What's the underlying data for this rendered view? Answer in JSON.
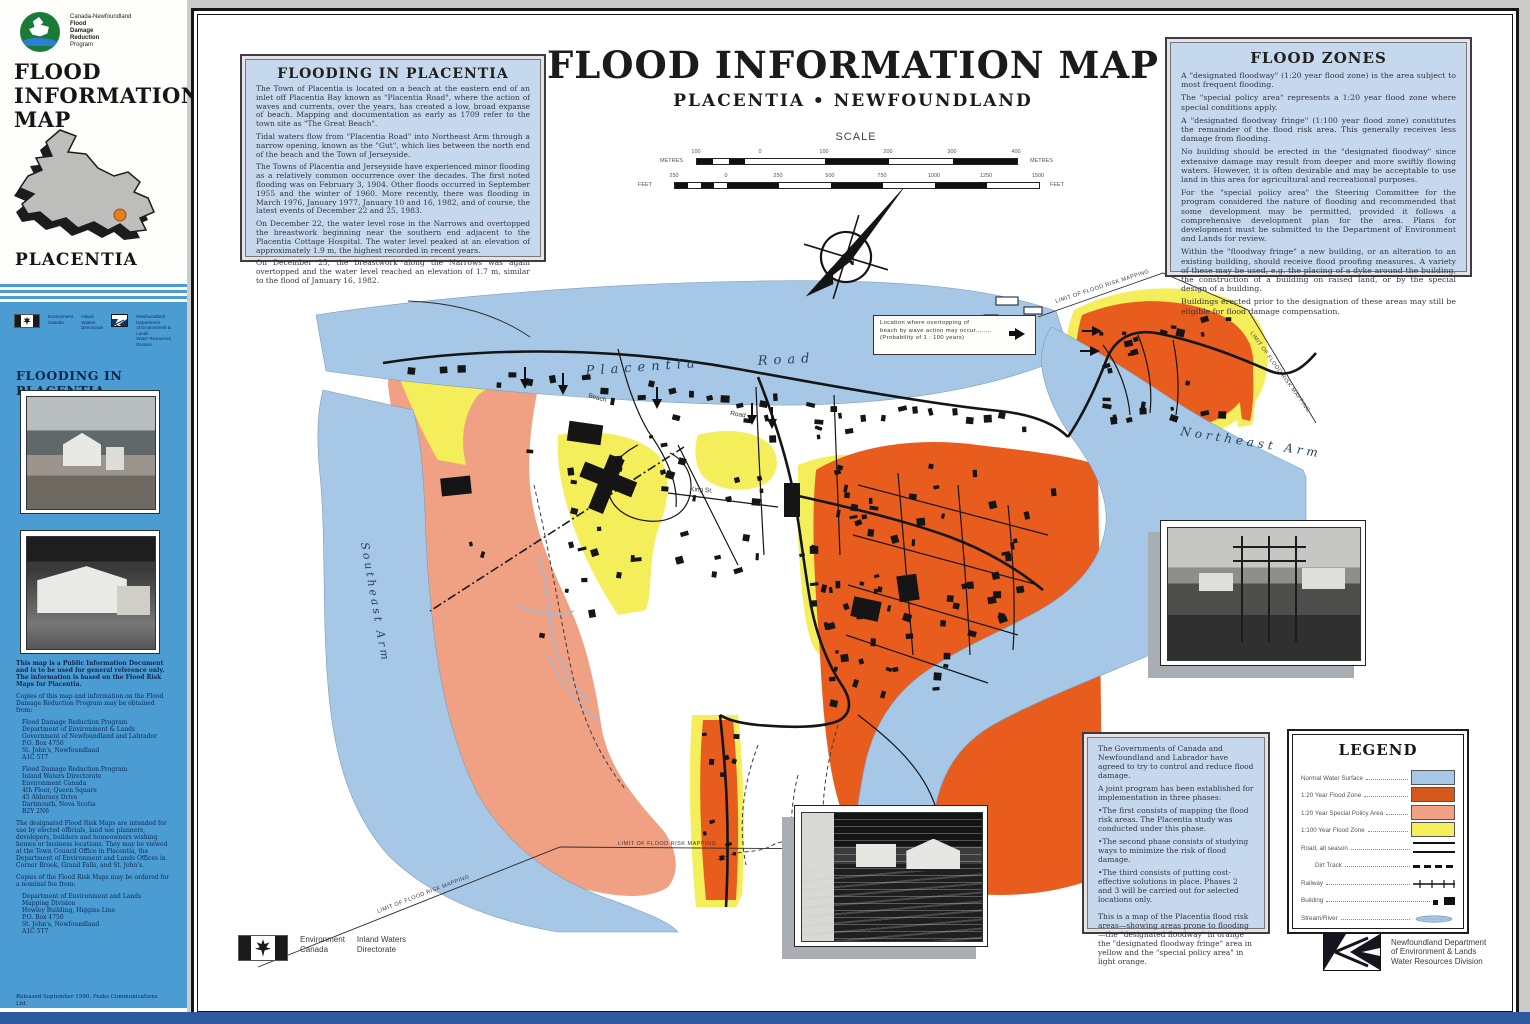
{
  "page": {
    "bottom_strip_color": "#2d5a9e"
  },
  "sidebar": {
    "program_logo": {
      "line1": "Canada-Newfoundland",
      "line2": "Flood",
      "line3": "Damage",
      "line4": "Reduction",
      "line5": "Program"
    },
    "title_line1": "FLOOD",
    "title_line2": "INFORMATION",
    "title_line3": "MAP",
    "region": "PLACENTIA",
    "logos": {
      "env1": "Environment",
      "env2": "Canada",
      "iw1": "Inland Waters",
      "iw2": "Directorate",
      "nf1": "Newfoundland Department",
      "nf2": "of Environment & Lands",
      "nf3": "Water Resources Division"
    },
    "heading": "FLOODING IN PLACENTIA",
    "paragraph1": "This map is a Public Information Document and is to be used for general reference only. The information is based on the Flood Risk Maps for Placentia.",
    "paragraph2": "Copies of this map and information on the Flood Damage Reduction Program may be obtained from:",
    "address1": "Flood Damage Reduction Program\nDepartment of Environment & Lands\nGovernment of Newfoundland and Labrador\nP.O. Box 4750\nSt. John's, Newfoundland\nA1C 5T7",
    "address2": "Flood Damage Reduction Program\nInland Waters Directorate\nEnvironment Canada\n4th Floor, Queen Square\n45 Alderney Drive\nDartmouth, Nova Scotia\nB2Y 2N6",
    "paragraph3": "The designated Flood Risk Maps are intended for use by elected officials, land use planners, developers, builders and homeowners wishing homes or business locations. They may be viewed at the Town Council Office in Placentia, the Department of Environment and Lands Offices in Corner Brook, Grand Falls, and St. John's.",
    "paragraph4": "Copies of the Flood Risk Maps may be ordered for a nominal fee from:",
    "address3": "Department of Environment and Lands\nMapping Division\nHowley Building, Higgins Line\nP.O. Box 4750\nSt. John's, Newfoundland\nA1C 5T7",
    "footnote": "Released September 1990, Peaks Communications Ltd."
  },
  "header": {
    "title": "FLOOD INFORMATION MAP",
    "subtitle": "PLACENTIA • NEWFOUNDLAND"
  },
  "scale": {
    "label": "SCALE",
    "metres_unit": "METRES",
    "feet_unit": "FEET",
    "metres_ticks": [
      "100",
      "0",
      "100",
      "200",
      "300",
      "400"
    ],
    "feet_ticks": [
      "250",
      "0",
      "250",
      "500",
      "750",
      "1000",
      "1250",
      "1500"
    ]
  },
  "flooding_box": {
    "title": "FLOODING IN PLACENTIA",
    "paragraphs": [
      "The Town of Placentia is located on a beach at the eastern end of an inlet off Placentia Bay known as \"Placentia Road\", where the action of waves and currents, over the years, has created a low, broad expanse of beach. Mapping and documentation as early as 1709 refer to the town site as \"The Great Beach\".",
      "Tidal waters flow from \"Placentia Road\" into Northeast Arm through a narrow opening, known as the \"Gut\", which lies between the north end of the beach and the Town of Jerseyside.",
      "The Towns of Placentia and Jerseyside have experienced minor flooding as a relatively common occurrence over the decades. The first noted flooding was on February 3, 1904. Other floods occurred in September 1955 and the winter of 1960. More recently, there was flooding in March 1976, January 1977, January 10 and 16, 1982, and of course, the latest events of December 22 and 25, 1983.",
      "On December 22, the water level rose in the Narrows and overtopped the breastwork beginning near the southern end adjacent to the Placentia Cottage Hospital. The water level peaked at an elevation of approximately 1.9 m, the highest recorded in recent years.",
      "On December 25, the breastwork along the Narrows was again overtopped and the water level reached an elevation of 1.7 m, similar to the flood of January 16, 1982."
    ]
  },
  "flood_zones_box": {
    "title": "FLOOD ZONES",
    "paragraphs": [
      "A \"designated floodway\" (1:20 year flood zone) is the area subject to most frequent flooding.",
      "The \"special policy area\" represents a 1:20 year flood zone where special conditions apply.",
      "A \"designated floodway fringe\" (1:100 year flood zone) constitutes the remainder of the flood risk area. This generally receives less damage from flooding.",
      "No building should be erected in the \"designated floodway\" since extensive damage may result from deeper and more swiftly flowing waters. However, it is often desirable and may be acceptable to use land in this area for agricultural and recreational purposes.",
      "For the \"special policy area\" the Steering Committee for the program considered the nature of flooding and recommended that some development may be permitted, provided it follows a comprehensive development plan for the area. Plans for development must be submitted to the Department of Environment and Lands for review.",
      "Within the \"floodway fringe\" a new building, or an alteration to an existing building, should receive flood proofing measures. A variety of these may be used, e.g. the placing of a dyke around the building, the construction of a building on raised land, or by the special design of a building.",
      "Buildings erected prior to the designation of these areas may still be eligible for flood damage compensation."
    ]
  },
  "program_box": {
    "paragraphs": [
      "The Governments of Canada and Newfoundland and Labrador have agreed to try to control and reduce flood damage.",
      "A joint program has been established for implementation in three phases:",
      "•The first consists of mapping the flood risk areas. The Placentia study was conducted under this phase.",
      "•The second phase consists of studying ways to minimize the risk of flood damage.",
      "•The third consists of putting cost-effective solutions in place. Phases 2 and 3 will be carried out for selected locations only.",
      "This is a map of the Placentia flood risk areas—showing areas prone to flooding—the \"designated floodway\" in orange the \"designated floodway fringe\" area in yellow and the \"special policy area\" in light orange."
    ]
  },
  "annotation_box": {
    "line1": "Location where overtopping of",
    "line2": "beach by wave action may occur........",
    "line3": "(Probability of 1 : 100 years)"
  },
  "map": {
    "labels": {
      "water_top_1": "Placentia",
      "water_top_2": "Road",
      "southeast": "Southeast  Arm",
      "northeast": "Northeast   Arm",
      "beach": "Beach",
      "road": "Road",
      "king": "King St.",
      "limit": "LIMIT OF FLOOD RISK MAPPING",
      "north": "N"
    },
    "colors": {
      "water": "#a6c7e6",
      "floodway": "#e85c1e",
      "special_policy": "#f0a184",
      "fringe": "#f3ee59"
    }
  },
  "legend": {
    "title": "LEGEND",
    "items": [
      {
        "label": "Normal Water Surface",
        "color": "#a6c7e6"
      },
      {
        "label": "1:20 Year Flood Zone",
        "color": "#d4571b"
      },
      {
        "label": "1:20 Year Special Policy Area",
        "color": "#f0a184"
      },
      {
        "label": "1:100 Year Flood Zone",
        "color": "#f3ee59"
      },
      {
        "label": "Road, all season"
      },
      {
        "label": "Dirt Track"
      },
      {
        "label": "Railway"
      },
      {
        "label": "Building"
      },
      {
        "label": "Stream/River"
      }
    ]
  },
  "footer": {
    "env1": "Environment",
    "env2": "Canada",
    "iw1": "Inland Waters",
    "iw2": "Directorate",
    "nf1": "Newfoundland Department",
    "nf2": "of Environment & Lands",
    "nf3": "Water Resources Division"
  }
}
